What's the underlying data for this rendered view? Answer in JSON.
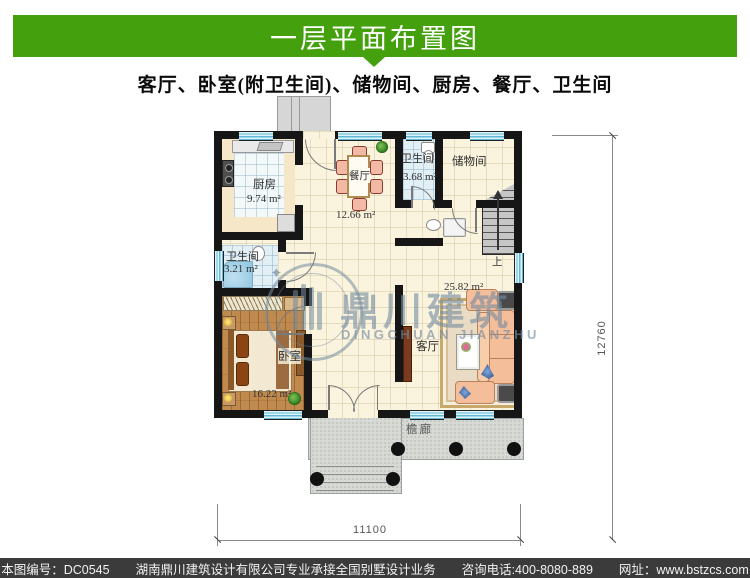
{
  "header": {
    "title": "一层平面布置图"
  },
  "subtitle": "客厅、卧室(附卫生间)、储物间、厨房、餐厅、卫生间",
  "colors": {
    "accent_green": "#44A00C",
    "wall": "#161616",
    "window_blue": "#5FB8D8",
    "footer_bg": "#3B3B3B"
  },
  "plan": {
    "rooms": {
      "kitchen": {
        "name": "厨房",
        "area": "9.74 m²"
      },
      "dining": {
        "name": "餐厅",
        "area": "12.66 m²"
      },
      "bath_top": {
        "name": "卫生间",
        "area": "3.68 m²"
      },
      "storage": {
        "name": "储物间"
      },
      "bath_left": {
        "name": "卫生间",
        "area": "3.21 m²"
      },
      "bedroom": {
        "name": "卧室",
        "area": "16.22 m²"
      },
      "living": {
        "name": "客厅",
        "area": "25.82 m²"
      },
      "porch": {
        "name": "檐廊"
      }
    },
    "stairs": {
      "up_label": "上"
    },
    "dimensions": {
      "height": "12760",
      "width": "11100"
    }
  },
  "watermark": {
    "cn": "鼎川建筑",
    "en": "DINGCHUAN JIANZHU"
  },
  "footer": {
    "drawing_no": "本图编号：DC0545",
    "company": "湖南鼎川建筑设计有限公司专业承接全国别墅设计业务",
    "phone": "咨询电话:400-8080-889",
    "website": "网址：www.bstzcs.com"
  }
}
